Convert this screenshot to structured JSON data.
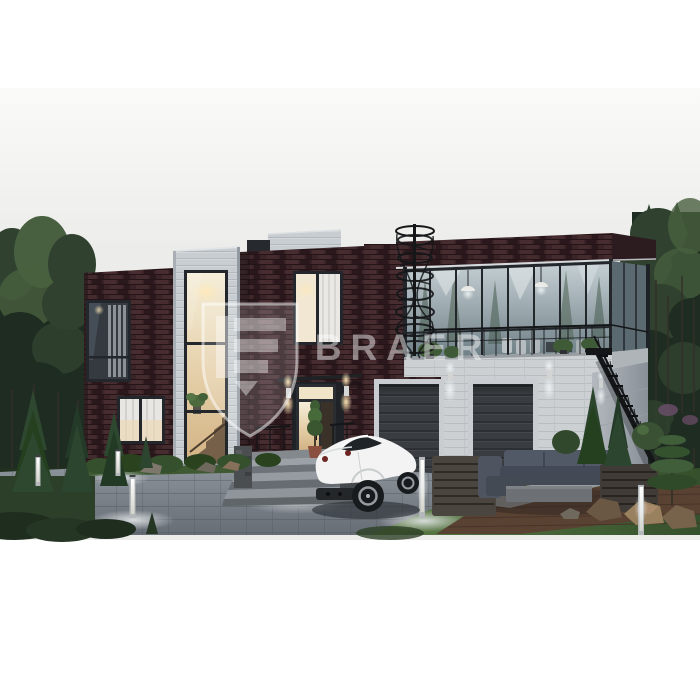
{
  "watermark": {
    "brand": "BRAER",
    "logo": "shield-icon",
    "opacity": "0.45"
  },
  "scene": {
    "type": "architectural-exterior-render",
    "time_of_day": "dusk",
    "description": "Dusk exterior rendering of a modern two-story flat-roof house with dark brown brick and light panel facades, a glass-walled upper lounge with roof terrace, a black spiral staircase, an exterior metal stair, two sectional garage doors, a glazed entrance with canopy and stone steps, a white sports car on a paved driveway, an outdoor lounge set on a wood deck, stainless bollard lights, conifers, boulders and a pine forest backdrop.",
    "objects": [
      "two-story modern house",
      "dark brown brick facade",
      "light panel stair tower",
      "glass lounge with roof terrace",
      "spiral staircase",
      "exterior metal staircase",
      "garage door",
      "garage door",
      "entrance door with canopy",
      "stone entrance steps",
      "white sports car",
      "paved driveway",
      "bollard lights",
      "outdoor sofa and concrete table",
      "louvered screen boxes",
      "wood deck",
      "conifer shrubs",
      "boulders",
      "pine forest"
    ]
  },
  "colors": {
    "sky": "#f1f1ef",
    "forest_deep": "#1e2c22",
    "forest_mid": "#30422f",
    "forest_light": "#48603f",
    "trunk": "#332f28",
    "brick": "#3a2428",
    "brick_hi": "#472d30",
    "brick_lo": "#2b181c",
    "panel": "#c8cdd1",
    "panel_line": "#b2b8bd",
    "white_brick": "#ccd0d3",
    "frame": "#23272b",
    "glass_top": "#c6d0d4",
    "glass_bot": "#6e7f86",
    "glass_side": "#5a6a70",
    "warm1": "#f5eed9",
    "warm2": "#e3cca4",
    "garage": "#393d41",
    "garage_line": "#2c3034",
    "trim": "#c9cdd1",
    "metal": "#141618",
    "drive": "#7e858c",
    "drive_dark": "#51575e",
    "grass": "#54733e",
    "grass_dark": "#2f4529",
    "deck": "#5a4232",
    "deck_line": "#47342a",
    "sofa": "#525966",
    "sofa_dark": "#434a56",
    "concrete": "#9aa0a5",
    "rock": "#77624c",
    "rock_hi": "#99805f"
  }
}
